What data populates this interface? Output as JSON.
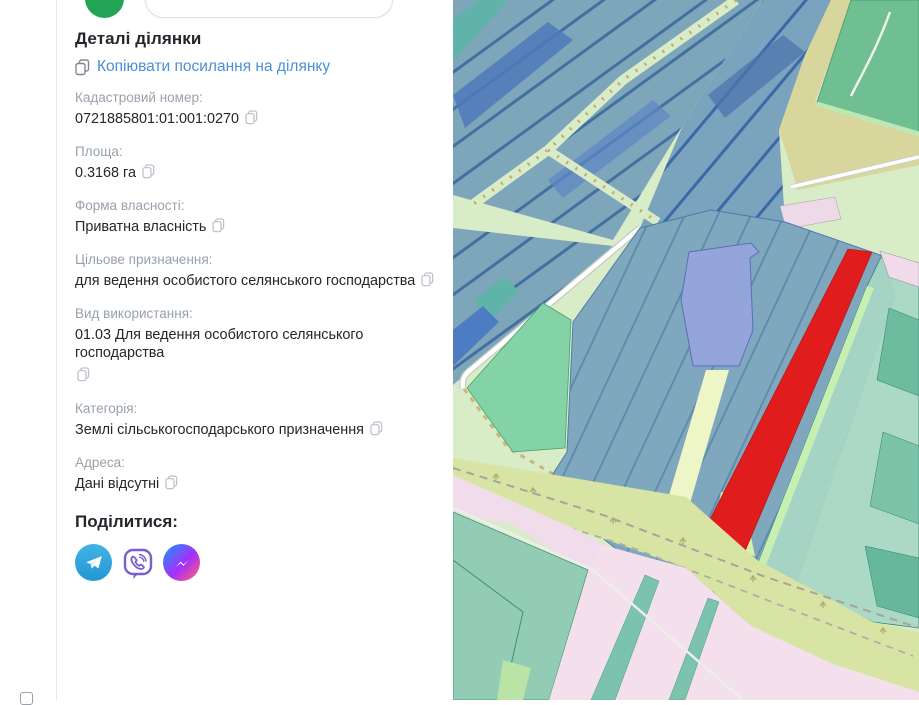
{
  "panel": {
    "title": "Деталі ділянки",
    "copy_link_label": "Копіювати посилання на ділянку",
    "fields": [
      {
        "label": "Кадастровий номер:",
        "value": "0721885801:01:001:0270"
      },
      {
        "label": "Площа:",
        "value": "0.3168 га"
      },
      {
        "label": "Форма власності:",
        "value": "Приватна власність"
      },
      {
        "label": "Цільове призначення:",
        "value": "для ведення особистого селянського господарства"
      },
      {
        "label": "Вид використання:",
        "value": "01.03 Для ведення особистого селянського господарства"
      },
      {
        "label": "Категорія:",
        "value": "Землі сільськогосподарського призначення"
      },
      {
        "label": "Адреса:",
        "value": "Дані відсутні"
      }
    ],
    "share_title": "Поділитися:",
    "share_buttons": [
      "telegram",
      "viber",
      "messenger"
    ],
    "search_value": "",
    "logo_color": "#22a454"
  },
  "map": {
    "selected_parcel_color": "#e11c1c",
    "parcel_blue": "#7fa7bd",
    "parcel_periwinkle": "#94a5da",
    "parcel_mint": "#a9d8c5",
    "parcel_green": "#6fbf92",
    "area_pink": "#f3e0ec",
    "area_teal": "#92ccb5",
    "road_band": "#d7e4a4",
    "background": "#d9ecc8"
  }
}
